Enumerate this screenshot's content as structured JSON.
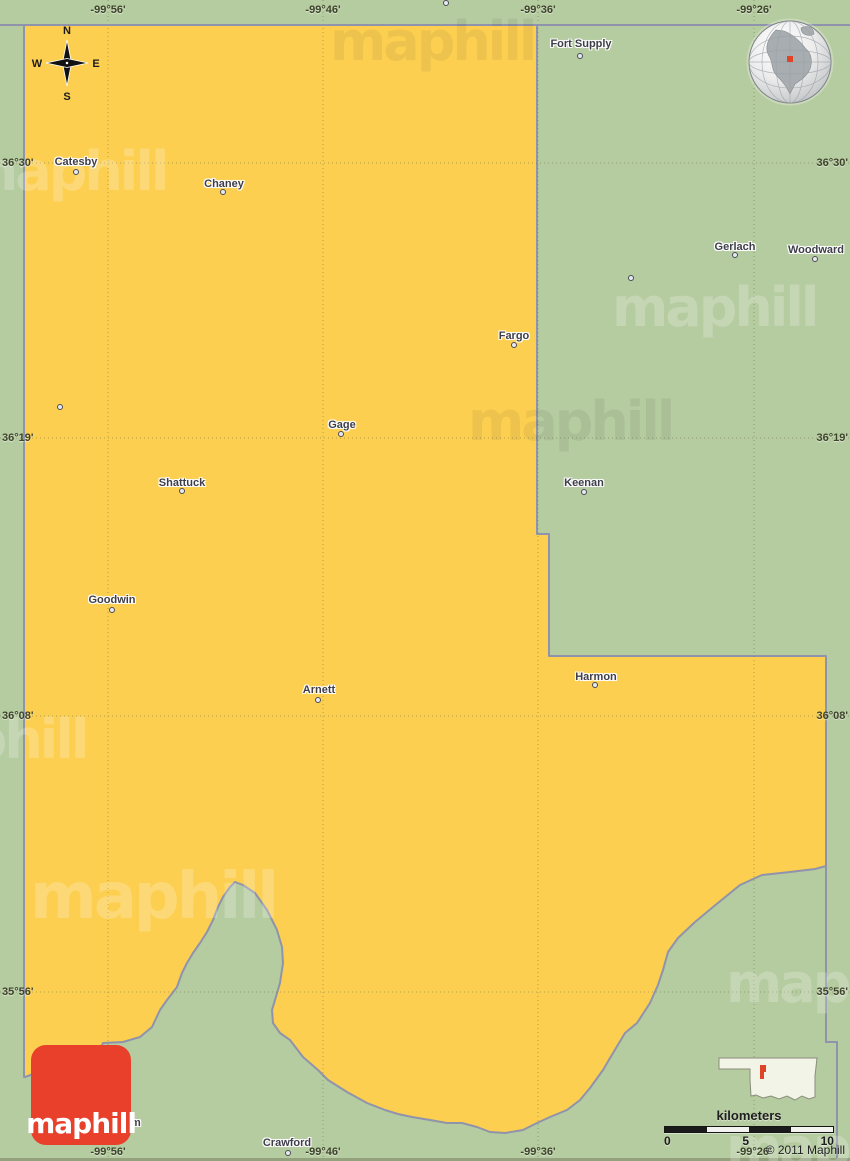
{
  "map": {
    "watermark_text": "maphill",
    "copyright": "© 2011 Maphill",
    "colors": {
      "county_fill": "#fccf50",
      "surrounding_fill": "#b5cba0",
      "boundary_line": "#8f93ac",
      "logo_red": "#e8402a",
      "marker_red": "#e04427"
    }
  },
  "compass": {
    "north": "N",
    "east": "E",
    "south": "S",
    "west": "W"
  },
  "grid": {
    "meridians": [
      {
        "label": "-99°56'",
        "x": 108
      },
      {
        "label": "-99°46'",
        "x": 323
      },
      {
        "label": "-99°36'",
        "x": 538
      },
      {
        "label": "-99°26'",
        "x": 754
      }
    ],
    "parallels": [
      {
        "label": "36°30'",
        "y": 163
      },
      {
        "label": "36°19'",
        "y": 438
      },
      {
        "label": "36°08'",
        "y": 716
      },
      {
        "label": "35°56'",
        "y": 992
      }
    ]
  },
  "towns": [
    {
      "name": "Fort Supply",
      "x": 581,
      "y": 44,
      "dx": 580,
      "dy": 56
    },
    {
      "name": "Catesby",
      "x": 76,
      "y": 162,
      "dx": 76,
      "dy": 172
    },
    {
      "name": "Chaney",
      "x": 224,
      "y": 184,
      "dx": 223,
      "dy": 192
    },
    {
      "name": "Gerlach",
      "x": 735,
      "y": 247,
      "dx": 735,
      "dy": 255
    },
    {
      "name": "Woodward",
      "x": 816,
      "y": 250,
      "dx": 815,
      "dy": 259
    },
    {
      "name": "Fargo",
      "x": 514,
      "y": 336,
      "dx": 514,
      "dy": 345
    },
    {
      "name": "Gage",
      "x": 342,
      "y": 425,
      "dx": 341,
      "dy": 434
    },
    {
      "name": "Shattuck",
      "x": 182,
      "y": 483,
      "dx": 182,
      "dy": 491
    },
    {
      "name": "Keenan",
      "x": 584,
      "y": 483,
      "dx": 584,
      "dy": 492
    },
    {
      "name": "Goodwin",
      "x": 112,
      "y": 600,
      "dx": 112,
      "dy": 610
    },
    {
      "name": "Arnett",
      "x": 319,
      "y": 690,
      "dx": 318,
      "dy": 700
    },
    {
      "name": "Harmon",
      "x": 596,
      "y": 677,
      "dx": 595,
      "dy": 685
    },
    {
      "name": "Durham",
      "x": 120,
      "y": 1123,
      "dx": 112,
      "dy": 1133
    },
    {
      "name": "Crawford",
      "x": 287,
      "y": 1143,
      "dx": 288,
      "dy": 1153
    }
  ],
  "unnamed_dots": [
    {
      "x": 446,
      "y": 3
    },
    {
      "x": 631,
      "y": 278
    },
    {
      "x": 60,
      "y": 407
    }
  ],
  "scalebar": {
    "title": "kilometers",
    "tick0": "0",
    "tick5": "5",
    "tick10": "10"
  },
  "logo": {
    "text": "maphill"
  }
}
